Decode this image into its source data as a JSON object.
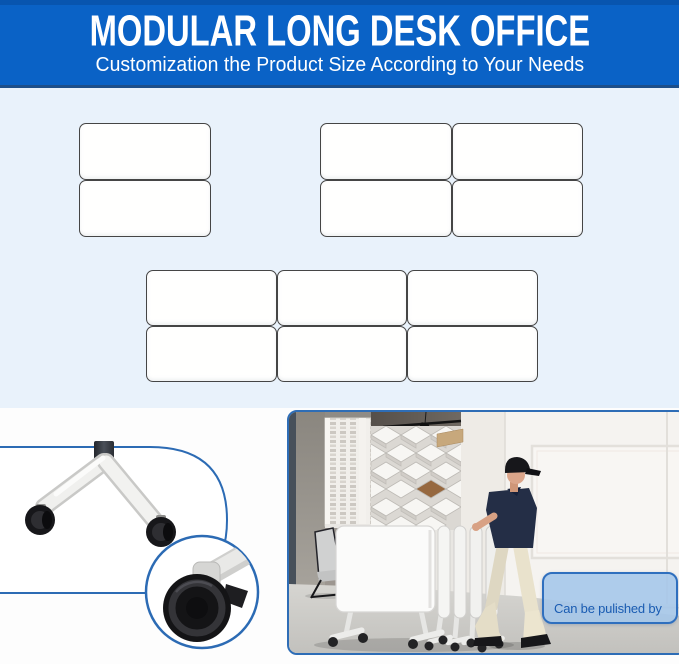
{
  "header": {
    "title": "MODULAR LONG DESK OFFICE",
    "subtitle": "Customization the Product Size According to Your Needs"
  },
  "diagram": {
    "groups": [
      {
        "id": "two-desk-column",
        "rows": 2,
        "cols": 1
      },
      {
        "id": "four-desk-grid",
        "rows": 2,
        "cols": 2
      },
      {
        "id": "six-desk-grid",
        "rows": 2,
        "cols": 3
      }
    ]
  },
  "details": {
    "caption": "Can be pulished by one\nperson"
  },
  "colors": {
    "banner_blue": "#0a62c6",
    "banner_edge": "#1d4f8a",
    "diagram_bg": "#e9f2fb",
    "tile_border": "#454545",
    "figure_border_blue": "#2e6db6",
    "caption_fill": "#a4c6e9",
    "caption_text": "#1a5cb2"
  }
}
